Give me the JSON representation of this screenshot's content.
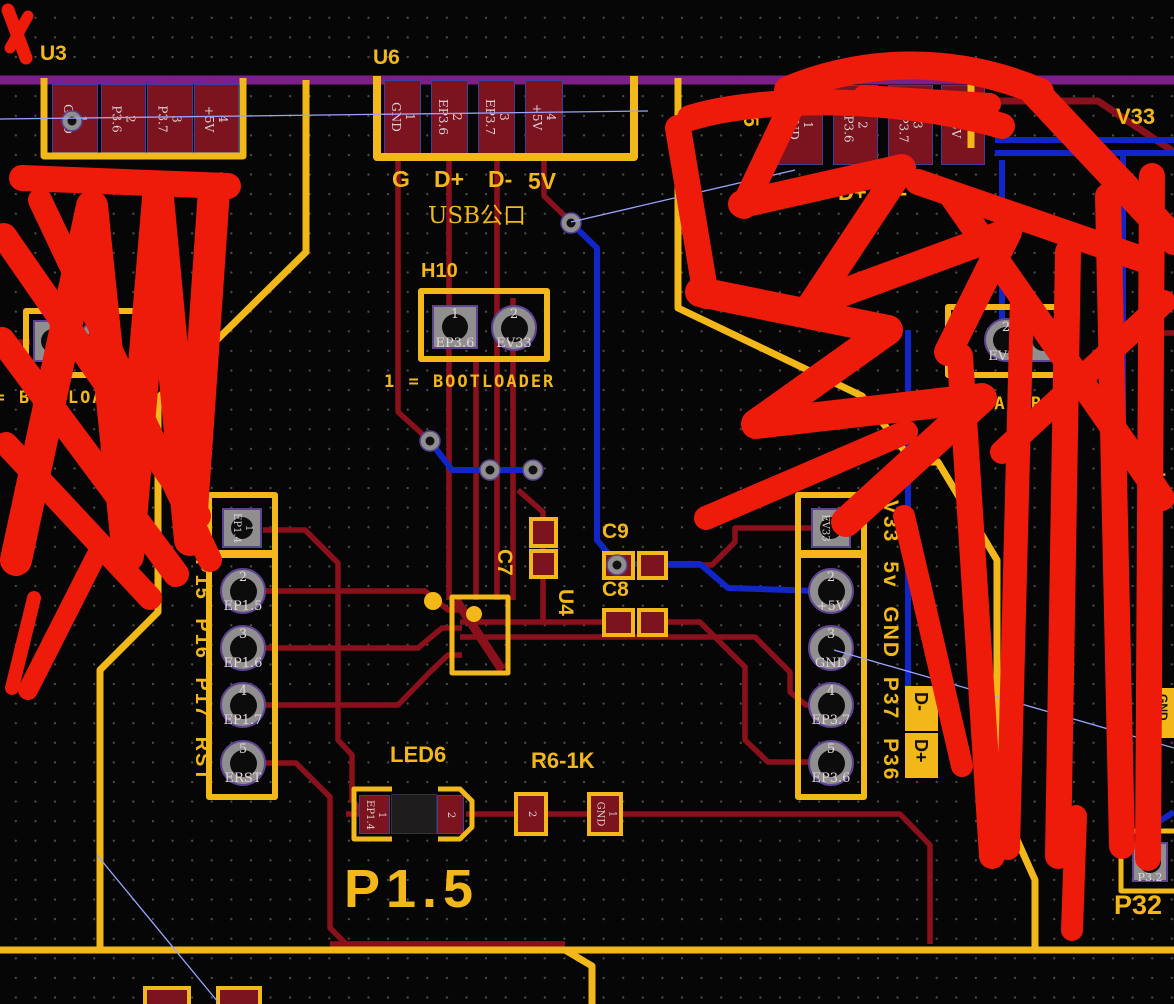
{
  "board": {
    "colors": {
      "silkscreen": "#f2b719",
      "copper_trace": "#8a101b",
      "pad_fill": "#7c1420",
      "blue_trace": "#1126c9",
      "purple_trace": "#7c1f88",
      "ratsnest": "#9aa3ff",
      "annotation_red": "#ee1a0a"
    },
    "u3": {
      "refdes": "U3",
      "pads": [
        "1\nGND",
        "2\nP3.6",
        "3\nP3.7",
        "4\n+5V"
      ],
      "pin_names": [
        "G",
        "D+",
        "D-",
        "5V"
      ]
    },
    "u6": {
      "refdes": "U6",
      "pads": [
        "1\nGND",
        "2\nEP3.6",
        "3\nEP3.7",
        "4\n+5V"
      ],
      "pin_names": [
        "G",
        "D+",
        "D-",
        "5V"
      ],
      "caption": "USB公口"
    },
    "u5": {
      "refdes": "U5",
      "pads": [
        "1\nGND",
        "2\nPP3.6",
        "3\nPP3.7",
        "4\n+5V"
      ],
      "pin_names": [
        "G",
        "D+",
        "D-",
        "5V"
      ]
    },
    "h10": {
      "refdes": "H10",
      "pad1": "1\nEP3.6",
      "pad2": "2\nEV33",
      "note": "1 = BOOTLOADER"
    },
    "h_left": {
      "pad2": "2\nEV33",
      "note": "1 = BOOTLOADER"
    },
    "h_right": {
      "pad2": "2\nEV33",
      "note": "1 = BOOTLOADER"
    },
    "left_header": {
      "silk": "P14 P15 P16 P17 RST",
      "pins": [
        "1\nEP1.4",
        "2\nEP1.5",
        "3\nEP1.6",
        "4\nEP1.7",
        "5\nERST"
      ]
    },
    "right_header": {
      "silk": "V33 5v GND P37 P36",
      "pins": [
        "1\nEV33",
        "2\n+5V",
        "3\nGND",
        "4\nEP3.7",
        "5\nEP3.6"
      ]
    },
    "c7": "C7",
    "c8": "C8",
    "c9": "C9",
    "u4": "U4",
    "led6": {
      "refdes": "LED6",
      "pad1": "1\nEP1.4",
      "pad2": "2"
    },
    "r6": {
      "refdes": "R6-1K",
      "pad_left": "2",
      "pad_right": "1\nGND"
    },
    "labels": {
      "p15": "P1.5",
      "v33": "V33",
      "c_top": "C",
      "c5": "C5",
      "p32": "P32",
      "p32_pad": "1\nP3.2",
      "d_minus": "D-",
      "d_plus": "D+",
      "gnd_tag": "GND"
    }
  }
}
